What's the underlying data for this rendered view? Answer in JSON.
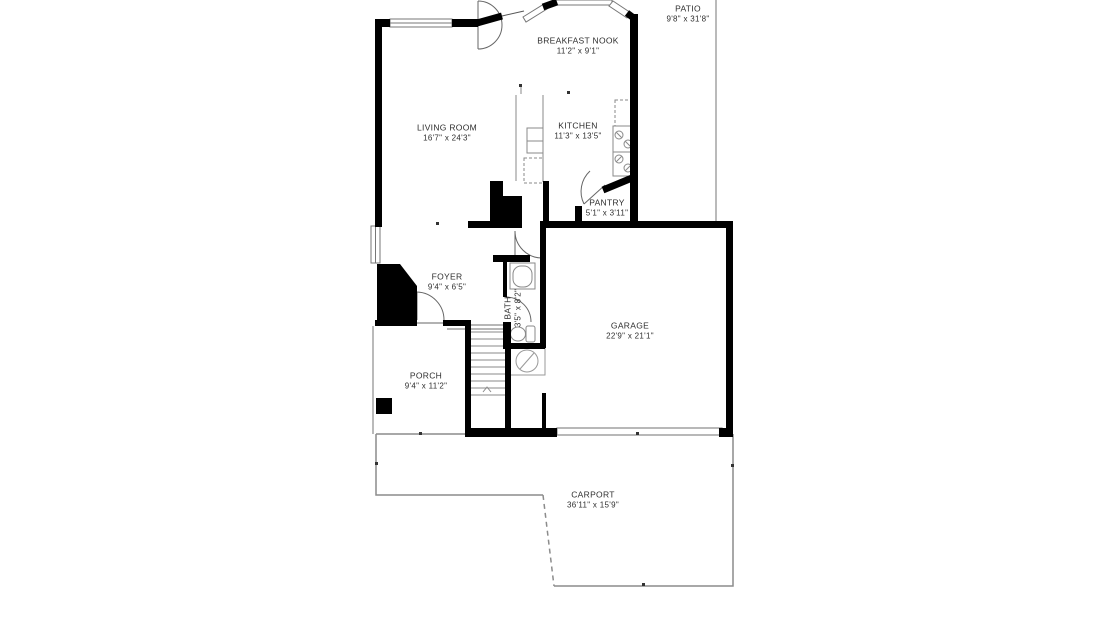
{
  "title": "Floor plan",
  "rooms": {
    "patio": {
      "name": "PATIO",
      "dims": "9'8\" x 31'8\""
    },
    "breakfast_nook": {
      "name": "BREAKFAST NOOK",
      "dims": "11'2\" x 9'1\""
    },
    "living_room": {
      "name": "LIVING ROOM",
      "dims": "16'7\" x 24'3\""
    },
    "kitchen": {
      "name": "KITCHEN",
      "dims": "11'3\" x 13'5\""
    },
    "pantry": {
      "name": "PANTRY",
      "dims": "5'1\" x 3'11\""
    },
    "foyer": {
      "name": "FOYER",
      "dims": "9'4\" x 6'5\""
    },
    "bath": {
      "name": "BATH",
      "dims": "3'5\" x 8'2\""
    },
    "garage": {
      "name": "GARAGE",
      "dims": "22'9\" x 21'1\""
    },
    "porch": {
      "name": "PORCH",
      "dims": "9'4\" x 11'2\""
    },
    "carport": {
      "name": "CARPORT",
      "dims": "36'11\" x 15'9\""
    }
  },
  "colors": {
    "wall": "#000000",
    "thin_line": "#8c8c8c",
    "fixture_line": "#8a8a8a",
    "door_arc": "#666666",
    "text": "#2e2e2e",
    "background": "#ffffff"
  }
}
